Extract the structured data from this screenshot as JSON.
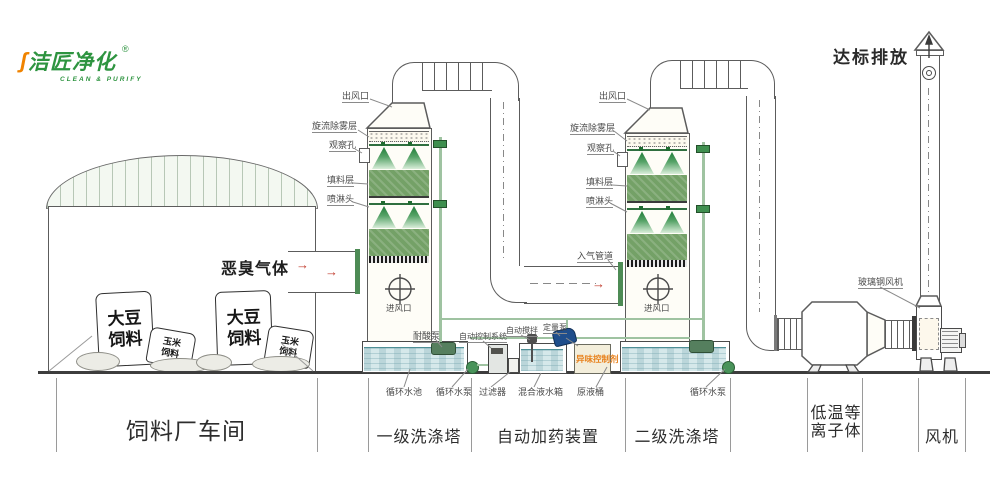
{
  "logo": {
    "name": "洁匠净化",
    "reg": "®",
    "tagline": "CLEAN & PURIFY"
  },
  "discharge_label": "达标排放",
  "workshop": {
    "odor_gas": "恶臭气体",
    "bag_large": "大豆饲料",
    "bag_small": "玉米饲料"
  },
  "tower_labels": {
    "outlet": "出风口",
    "demister": "旋流除雾层",
    "observation": "观察孔",
    "packing": "填料层",
    "spray": "喷淋头",
    "inlet": "进风口",
    "gas_inlet_pipe": "入气管道"
  },
  "equipment_labels": {
    "acid_pump": "耐酸泵",
    "control_system": "自动控制系统",
    "auto_stir": "自动搅拌",
    "metering_pump": "定量泵",
    "odor_agent": "异味控制剂",
    "frp_fan": "玻璃钢风机",
    "plasma_logo": "洁匠净化"
  },
  "under_labels": {
    "pool": "循环水池",
    "pump1": "循环水泵",
    "filter": "过滤器",
    "mix_tank": "混合液水箱",
    "raw_barrel": "原液桶",
    "pump2": "循环水泵"
  },
  "sections": [
    {
      "label": "饲料厂车间"
    },
    {
      "label": "一级洗涤塔"
    },
    {
      "label": "自动加药装置"
    },
    {
      "label": "二级洗涤塔"
    },
    {
      "label_line1": "低温等",
      "label_line2": "离子体"
    },
    {
      "label": "风机"
    }
  ],
  "colors": {
    "packing_green": "#74a167",
    "logo_green": "#2e9440",
    "logo_orange": "#f08300",
    "arrow_red": "#c0392b",
    "agent_orange": "#e8821e",
    "water_blue": "#d5e8ea",
    "pump_blue": "#1f4e8c",
    "line_gray": "#5c5c5c"
  }
}
